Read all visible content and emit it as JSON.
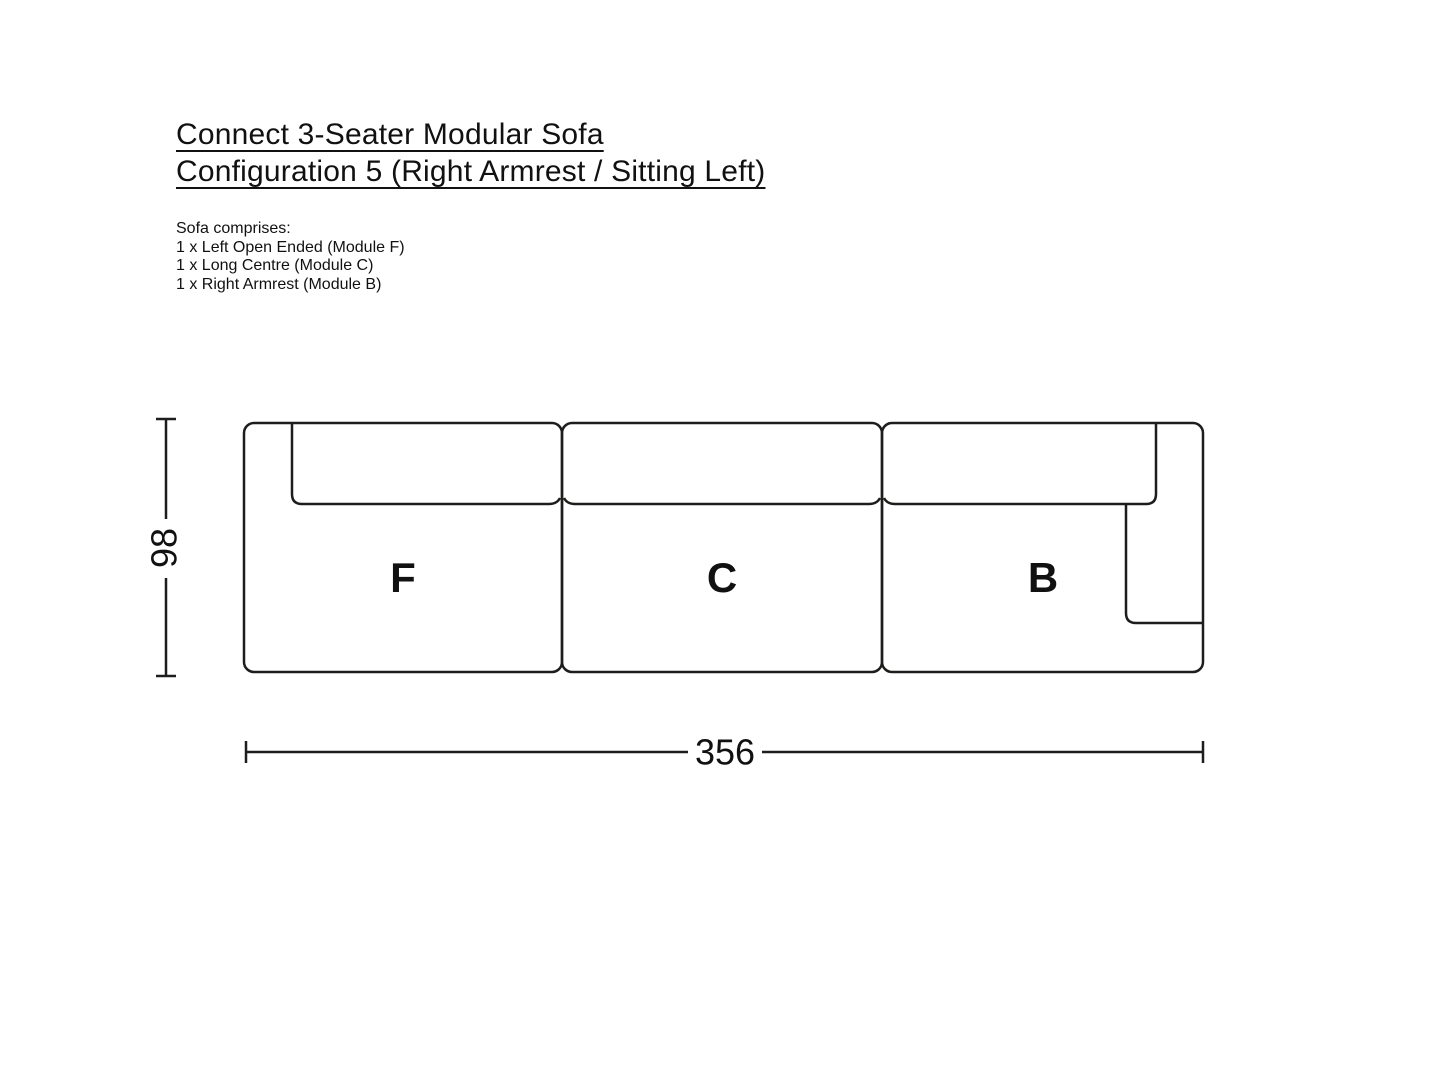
{
  "title": {
    "line1": "Connect 3-Seater Modular Sofa",
    "line2": "Configuration 5 (Right Armrest / Sitting Left)"
  },
  "comprises": {
    "heading": "Sofa comprises:",
    "items": [
      "1 x Left Open Ended (Module F)",
      "1 x Long Centre (Module C)",
      "1 x Right Armrest (Module B)"
    ]
  },
  "diagram": {
    "modules": [
      {
        "label": "F"
      },
      {
        "label": "C"
      },
      {
        "label": "B"
      }
    ],
    "dimensions": {
      "height": "98",
      "width": "356"
    }
  },
  "colors": {
    "ink": "#1d1d1b",
    "text": "#111111",
    "background": "#ffffff"
  }
}
